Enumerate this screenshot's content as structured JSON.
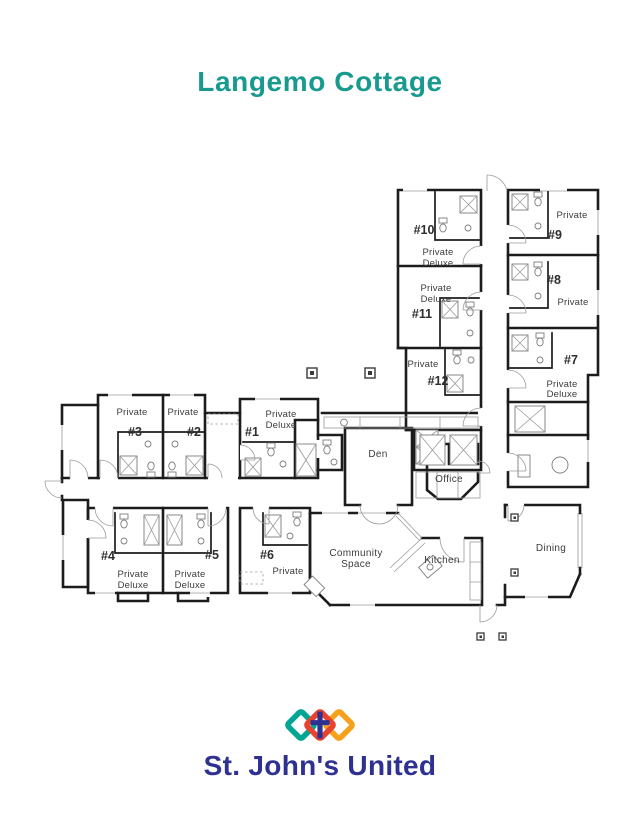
{
  "page": {
    "title": "Langemo Cottage"
  },
  "brand": {
    "name": "St. John's United",
    "title_color": "#189a8e",
    "logo_text_color": "#2e3192",
    "logo_mark_colors": {
      "left_diamond": "#00a693",
      "middle_diamond": "#e8432e",
      "right_diamond": "#f5a11c",
      "cross": "#2e3192"
    }
  },
  "floor_plan": {
    "wall_color": "#1c1c1c",
    "rooms": [
      {
        "number": "#1",
        "type": "Private Deluxe",
        "lines": [
          "Private",
          "Deluxe"
        ]
      },
      {
        "number": "#2",
        "type": "Private",
        "lines": [
          "Private"
        ]
      },
      {
        "number": "#3",
        "type": "Private",
        "lines": [
          "Private"
        ]
      },
      {
        "number": "#4",
        "type": "Private Deluxe",
        "lines": [
          "Private",
          "Deluxe"
        ]
      },
      {
        "number": "#5",
        "type": "Private Deluxe",
        "lines": [
          "Private",
          "Deluxe"
        ]
      },
      {
        "number": "#6",
        "type": "Private",
        "lines": [
          "Private"
        ]
      },
      {
        "number": "#7",
        "type": "Private Deluxe",
        "lines": [
          "Private",
          "Deluxe"
        ]
      },
      {
        "number": "#8",
        "type": "Private",
        "lines": [
          "Private"
        ]
      },
      {
        "number": "#9",
        "type": "Private",
        "lines": [
          "Private"
        ]
      },
      {
        "number": "#10",
        "type": "Private Deluxe",
        "lines": [
          "Private",
          "Deluxe"
        ]
      },
      {
        "number": "#11",
        "type": "Private Deluxe",
        "lines": [
          "Private",
          "Deluxe"
        ]
      },
      {
        "number": "#12",
        "type": "Private",
        "lines": [
          "Private"
        ]
      }
    ],
    "common_areas": [
      {
        "name": "Den"
      },
      {
        "name": "Office"
      },
      {
        "name": "Community Space",
        "lines": [
          "Community",
          "Space"
        ]
      },
      {
        "name": "Kitchen"
      },
      {
        "name": "Dining"
      }
    ]
  }
}
